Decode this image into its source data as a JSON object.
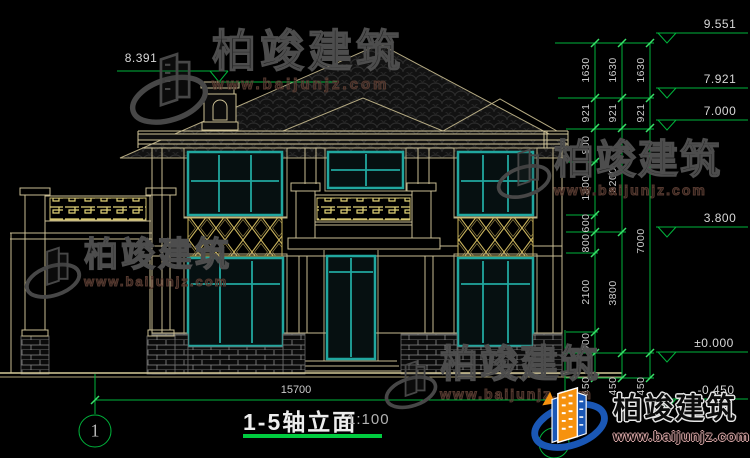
{
  "brand": {
    "name": "柏竣建筑",
    "site": "www.baijunjz.com"
  },
  "title": {
    "name": "1-5轴立面",
    "scale": "1:100"
  },
  "axis": {
    "left_bubble": "1"
  },
  "dims": {
    "total_width": "15700",
    "chain_inner": [
      "1630",
      "921",
      "800",
      "1800",
      "600",
      "800",
      "2100",
      "900",
      "450"
    ],
    "chain_mid": [
      "1630",
      "921",
      "3200",
      "3800",
      "450"
    ],
    "chain_outer": [
      "1630",
      "921",
      "7000",
      "450"
    ]
  },
  "levels": {
    "left": "8.391",
    "right": [
      "9.551",
      "7.921",
      "7.000",
      "3.800",
      "±0.000",
      "-0.450"
    ]
  }
}
